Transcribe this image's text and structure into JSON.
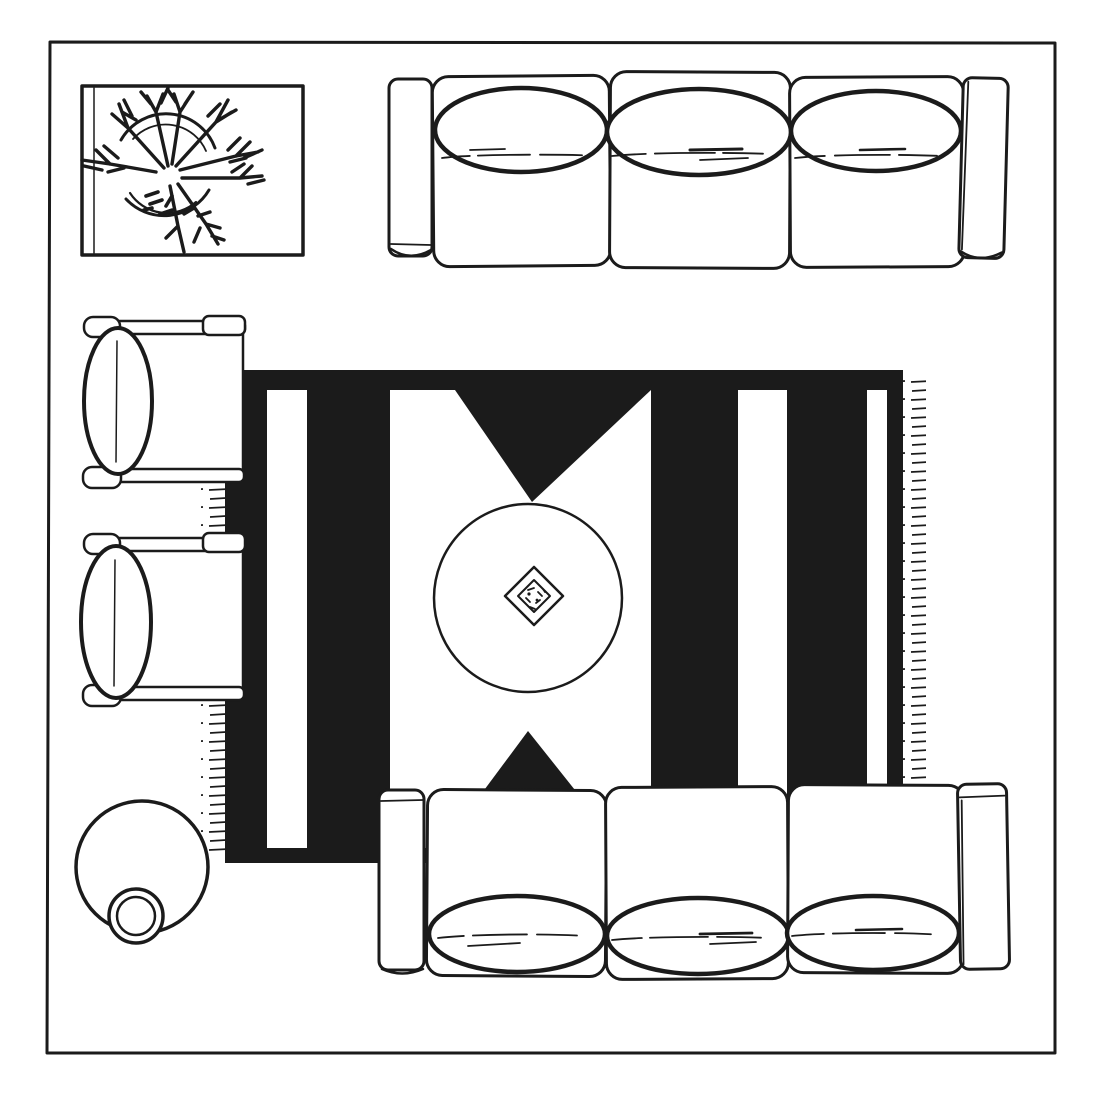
{
  "colors": {
    "ink": "#1b1b1b",
    "paper": "#ffffff"
  },
  "scene": {
    "label": "living-room-floor-plan-top-view",
    "style": "black-and-white hand-drawn line illustration",
    "items": [
      {
        "name": "plant-on-tray",
        "position": "top-left",
        "shape": "rectangular tray with round potted plant"
      },
      {
        "name": "sofa",
        "position": "top",
        "seats": 3,
        "back_pillows": 3,
        "armrests": 2
      },
      {
        "name": "armchair",
        "position": "left-upper",
        "back_pillow": 1
      },
      {
        "name": "armchair",
        "position": "left-lower",
        "back_pillow": 1
      },
      {
        "name": "area-rug",
        "position": "center",
        "pattern": "black field with white vertical stripes, white center panel and two black triangles",
        "white_stripes": 3,
        "triangles": 2,
        "fringed_edges": [
          "left",
          "right"
        ]
      },
      {
        "name": "coffee-table",
        "shape": "round",
        "position": "rug-center"
      },
      {
        "name": "decorative-tray",
        "shape": "double diamond with small objects",
        "position": "coffee-table-center"
      },
      {
        "name": "side-table-with-vase",
        "shape": "two overlapping circles",
        "position": "bottom-left"
      },
      {
        "name": "sofa",
        "position": "bottom",
        "seats": 3,
        "back_pillows": 3,
        "armrests": 2
      }
    ]
  }
}
